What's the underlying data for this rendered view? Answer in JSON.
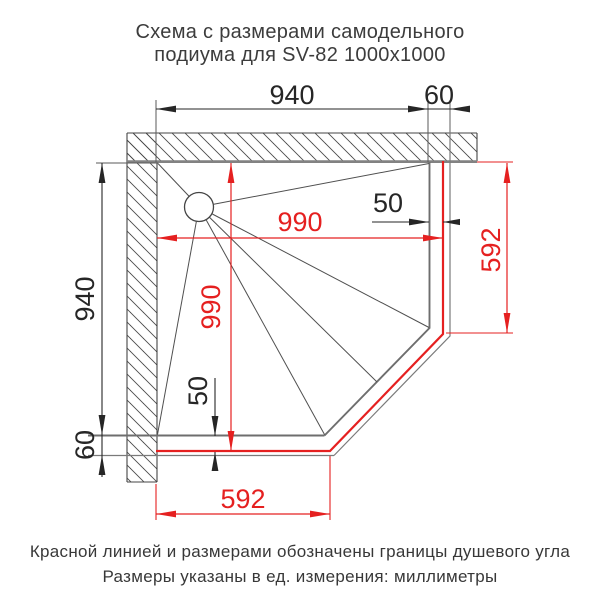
{
  "title": {
    "line1": "Схема с размерами самодельного",
    "line2": "подиума для SV-82 1000x1000"
  },
  "diagram": {
    "type": "dimensioned technical plan of a corner shower podium (pentagon slab with cut corner, drain circle with slope fold lines, hatched walls)",
    "dimensions": {
      "podium_width_top": "940",
      "gap_top_right": "60",
      "podium_height_left": "940",
      "gap_bottom_left": "60",
      "shower_width": "990",
      "shower_depth": "990",
      "offset_right": "50",
      "offset_bottom": "50",
      "shower_side_right": "592",
      "shower_side_bottom": "592"
    },
    "colors": {
      "shower_boundary_red": "#e52020",
      "drawing_gray": "#4f4f4f"
    }
  },
  "footer": {
    "line1": "Красной линией и размерами обозначены границы душевого угла",
    "line2": "Размеры указаны в ед. измерения: миллиметры"
  }
}
